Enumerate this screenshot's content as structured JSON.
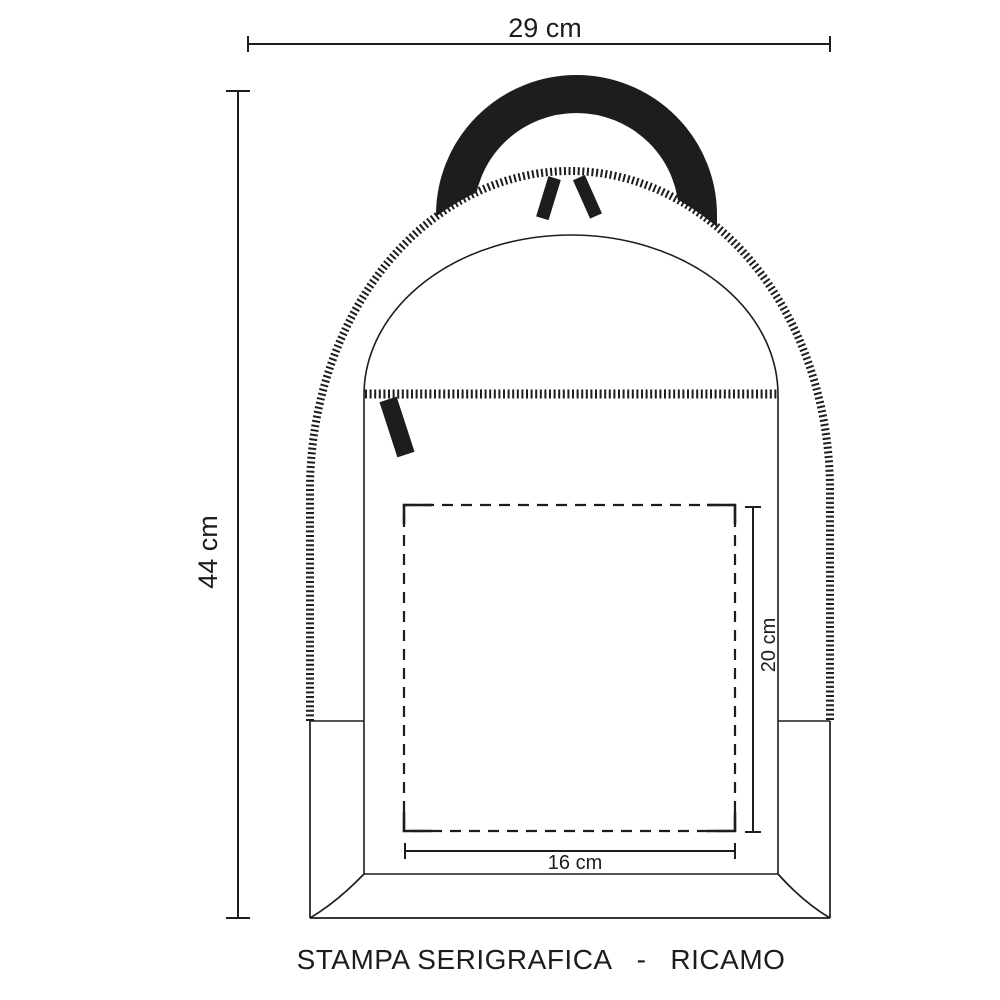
{
  "drawing": {
    "title": "backpack-print-area-spec",
    "dim_width_label": "29 cm",
    "dim_height_label": "44 cm",
    "dim_print_height_label": "20 cm",
    "dim_print_width_label": "16 cm"
  },
  "footer": {
    "part1": "STAMPA SERIGRAFICA",
    "separator": "-",
    "part2": "RICAMO"
  },
  "colors": {
    "ink": "#1d1d1b",
    "background": "#ffffff"
  }
}
